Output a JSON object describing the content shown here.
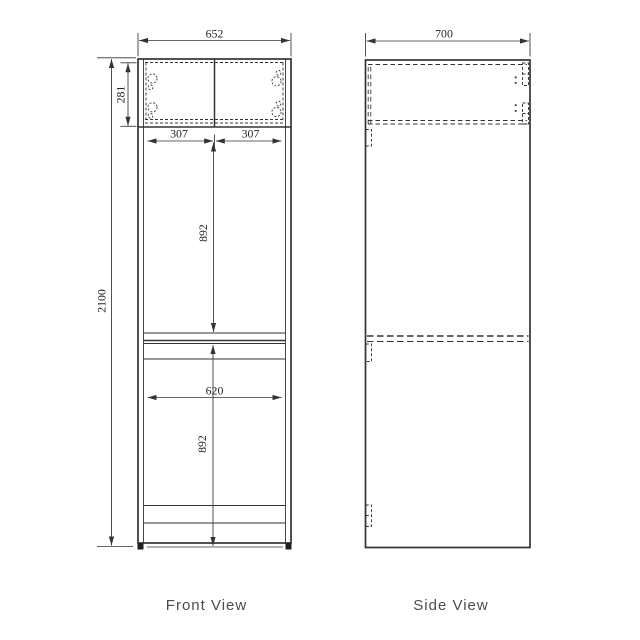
{
  "colors": {
    "line": "#333333",
    "dimension_text": "#242424",
    "label_text": "#4c4c4c",
    "background": "#ffffff"
  },
  "front_view": {
    "label": "Front View",
    "dimensions": {
      "overall_width": "652",
      "overall_height": "2100",
      "top_cabinet_height": "281",
      "top_door_left_width": "307",
      "top_door_right_width": "307",
      "upper_compartment_height": "892",
      "lower_compartment_width": "620",
      "lower_compartment_height": "892"
    }
  },
  "side_view": {
    "label": "Side View",
    "dimensions": {
      "overall_depth": "700"
    }
  }
}
